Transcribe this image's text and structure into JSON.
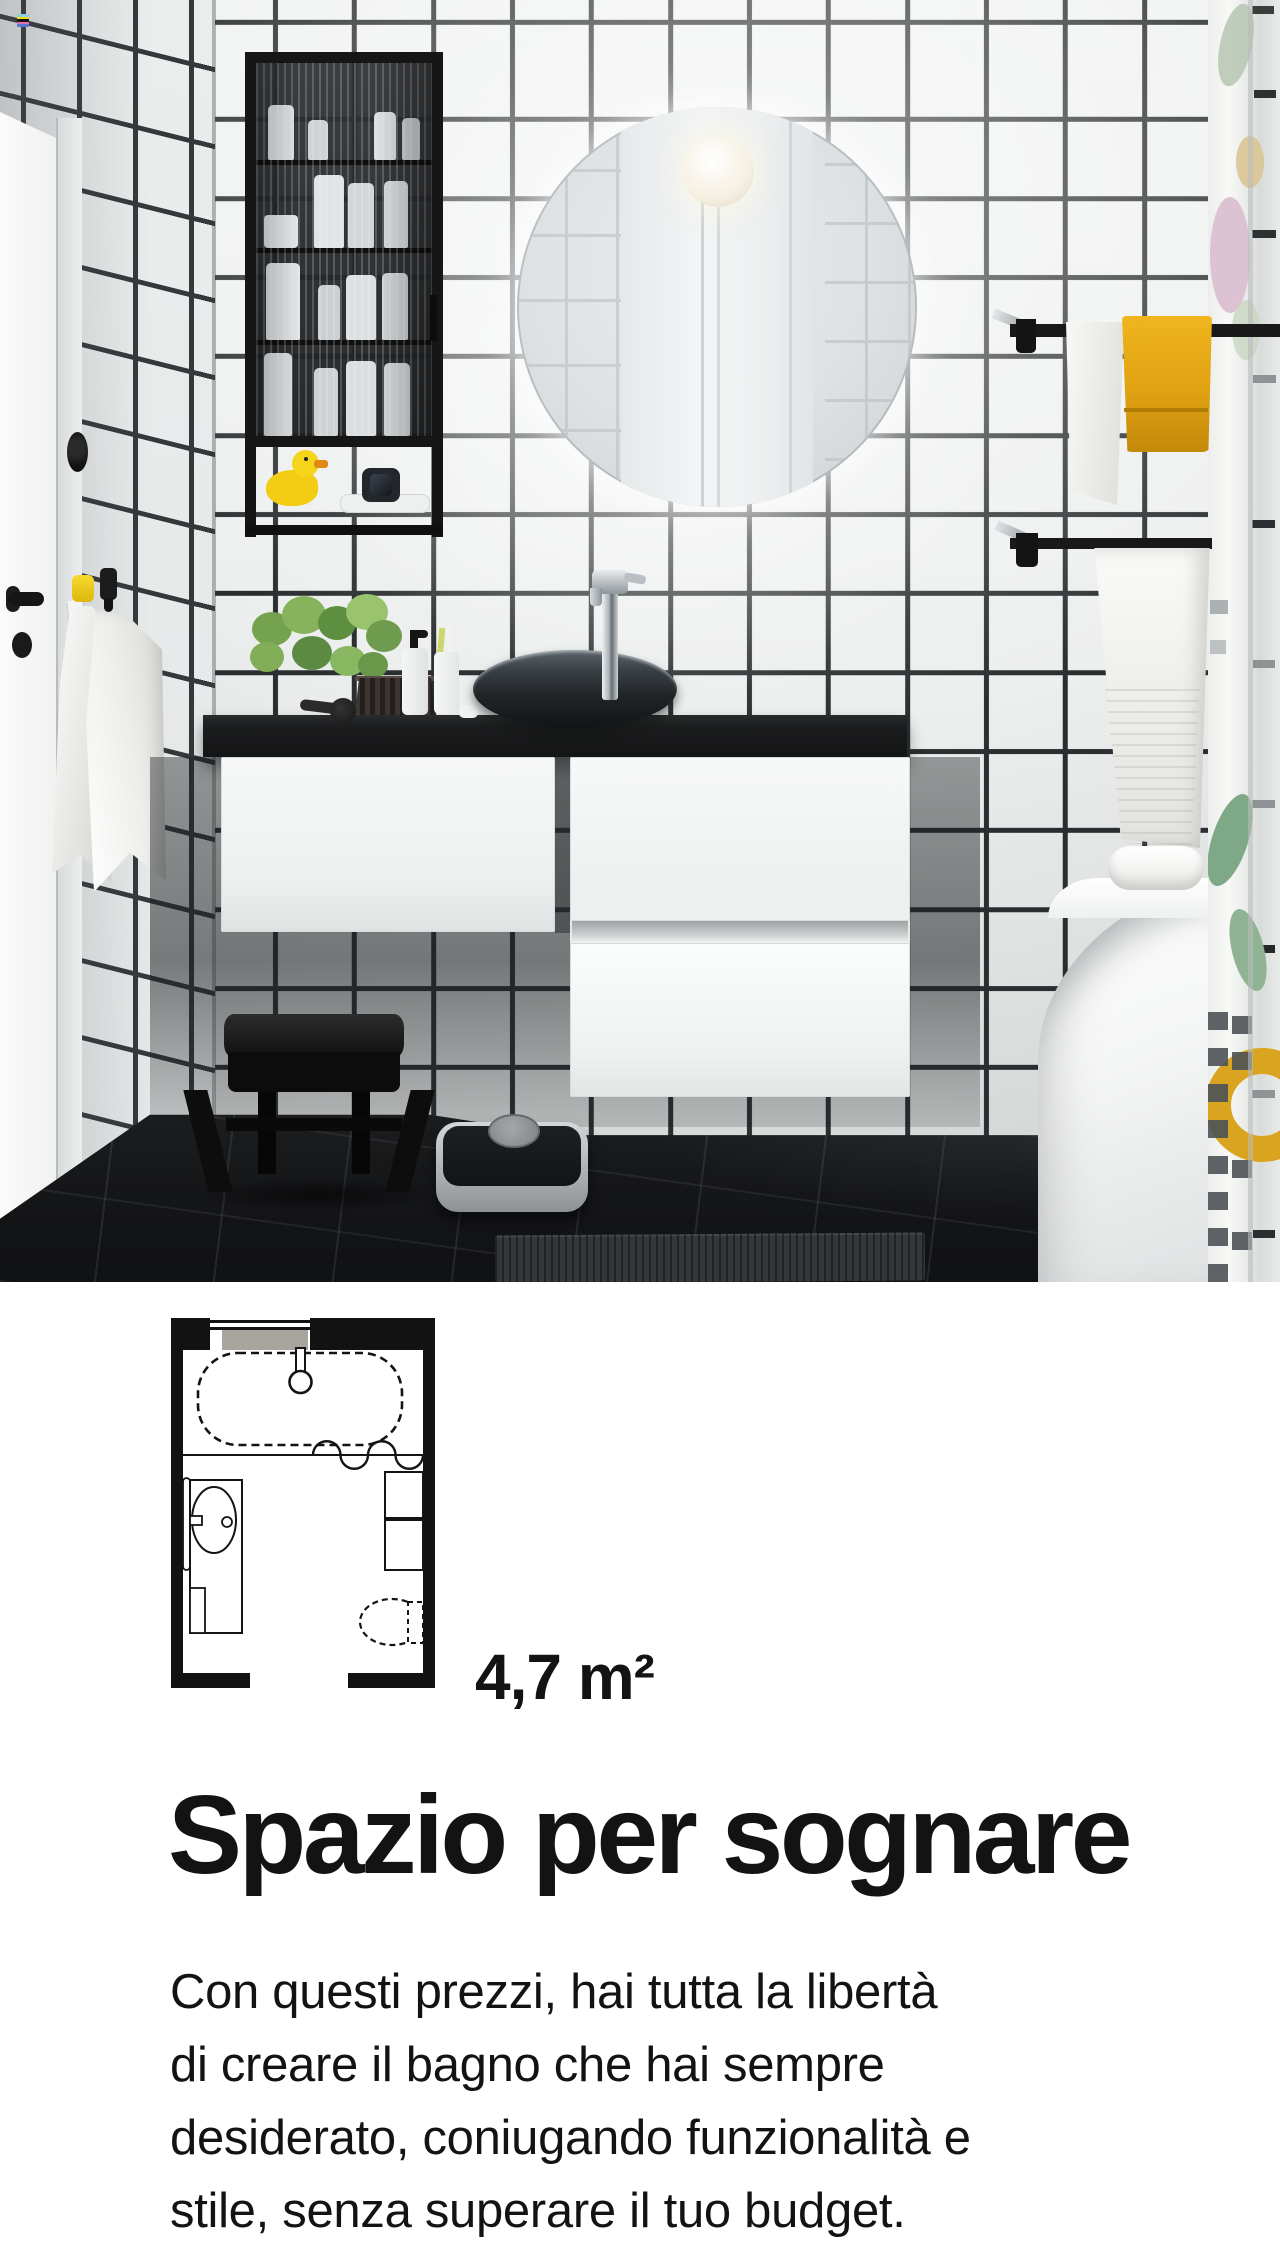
{
  "floor_plan": {
    "area_label": "4,7 m²"
  },
  "content": {
    "heading": "Spazio per sognare",
    "paragraph_lines": [
      "Con questi prezzi, hai tutta la libertà",
      "di creare il bagno che hai sempre",
      "desiderato, coniugando funzionalità e",
      "stile, senza superare il tuo budget."
    ]
  },
  "colors": {
    "accent_yellow": "#e0a112",
    "tile_grout": "#2b2e30",
    "countertop_black": "#1b1c1d",
    "floor_dark": "#151618",
    "heading_text": "#131313"
  }
}
